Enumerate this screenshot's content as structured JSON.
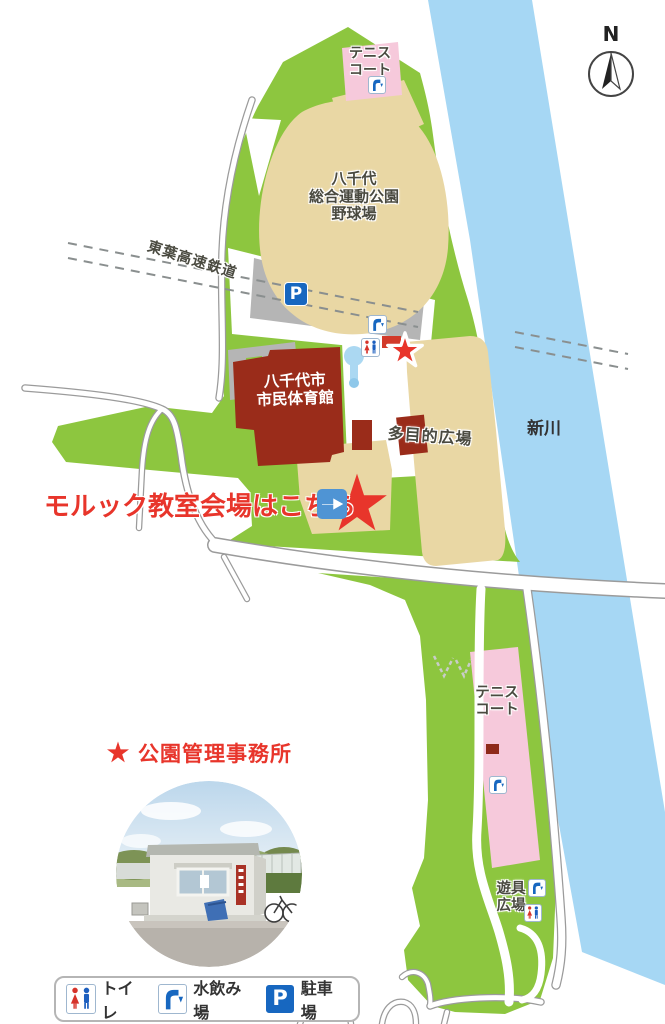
{
  "map": {
    "compass": "N",
    "river": "新川",
    "railway": "東葉高速鉄道",
    "areas": {
      "tennis_north": "テニス\nコート",
      "baseball": "八千代\n総合運動公園\n野球場",
      "gymnasium": "八千代市\n市民体育館",
      "multipurpose": "多目的広場",
      "tennis_east": "テニス\nコート",
      "playground": "遊具\n広場"
    },
    "markers": {
      "parking_letter": "P",
      "venue_callout": "モルック教室会場はこちら",
      "office_callout": "公園管理事務所"
    },
    "colors": {
      "park_green": "#8dc63f",
      "river_blue": "#a6d7f4",
      "field_tan": "#e9d7a4",
      "court_pink": "#f6c9db",
      "gym_red": "#9a2c1a",
      "accent_red": "#e8352b",
      "icon_blue": "#1767c0",
      "road_gray": "#9b9b9b",
      "parking_gray": "#b5b5b5"
    }
  },
  "legend": {
    "toilet": "トイレ",
    "fountain": "水飲み場",
    "parking": "駐車場",
    "parking_letter": "P"
  }
}
